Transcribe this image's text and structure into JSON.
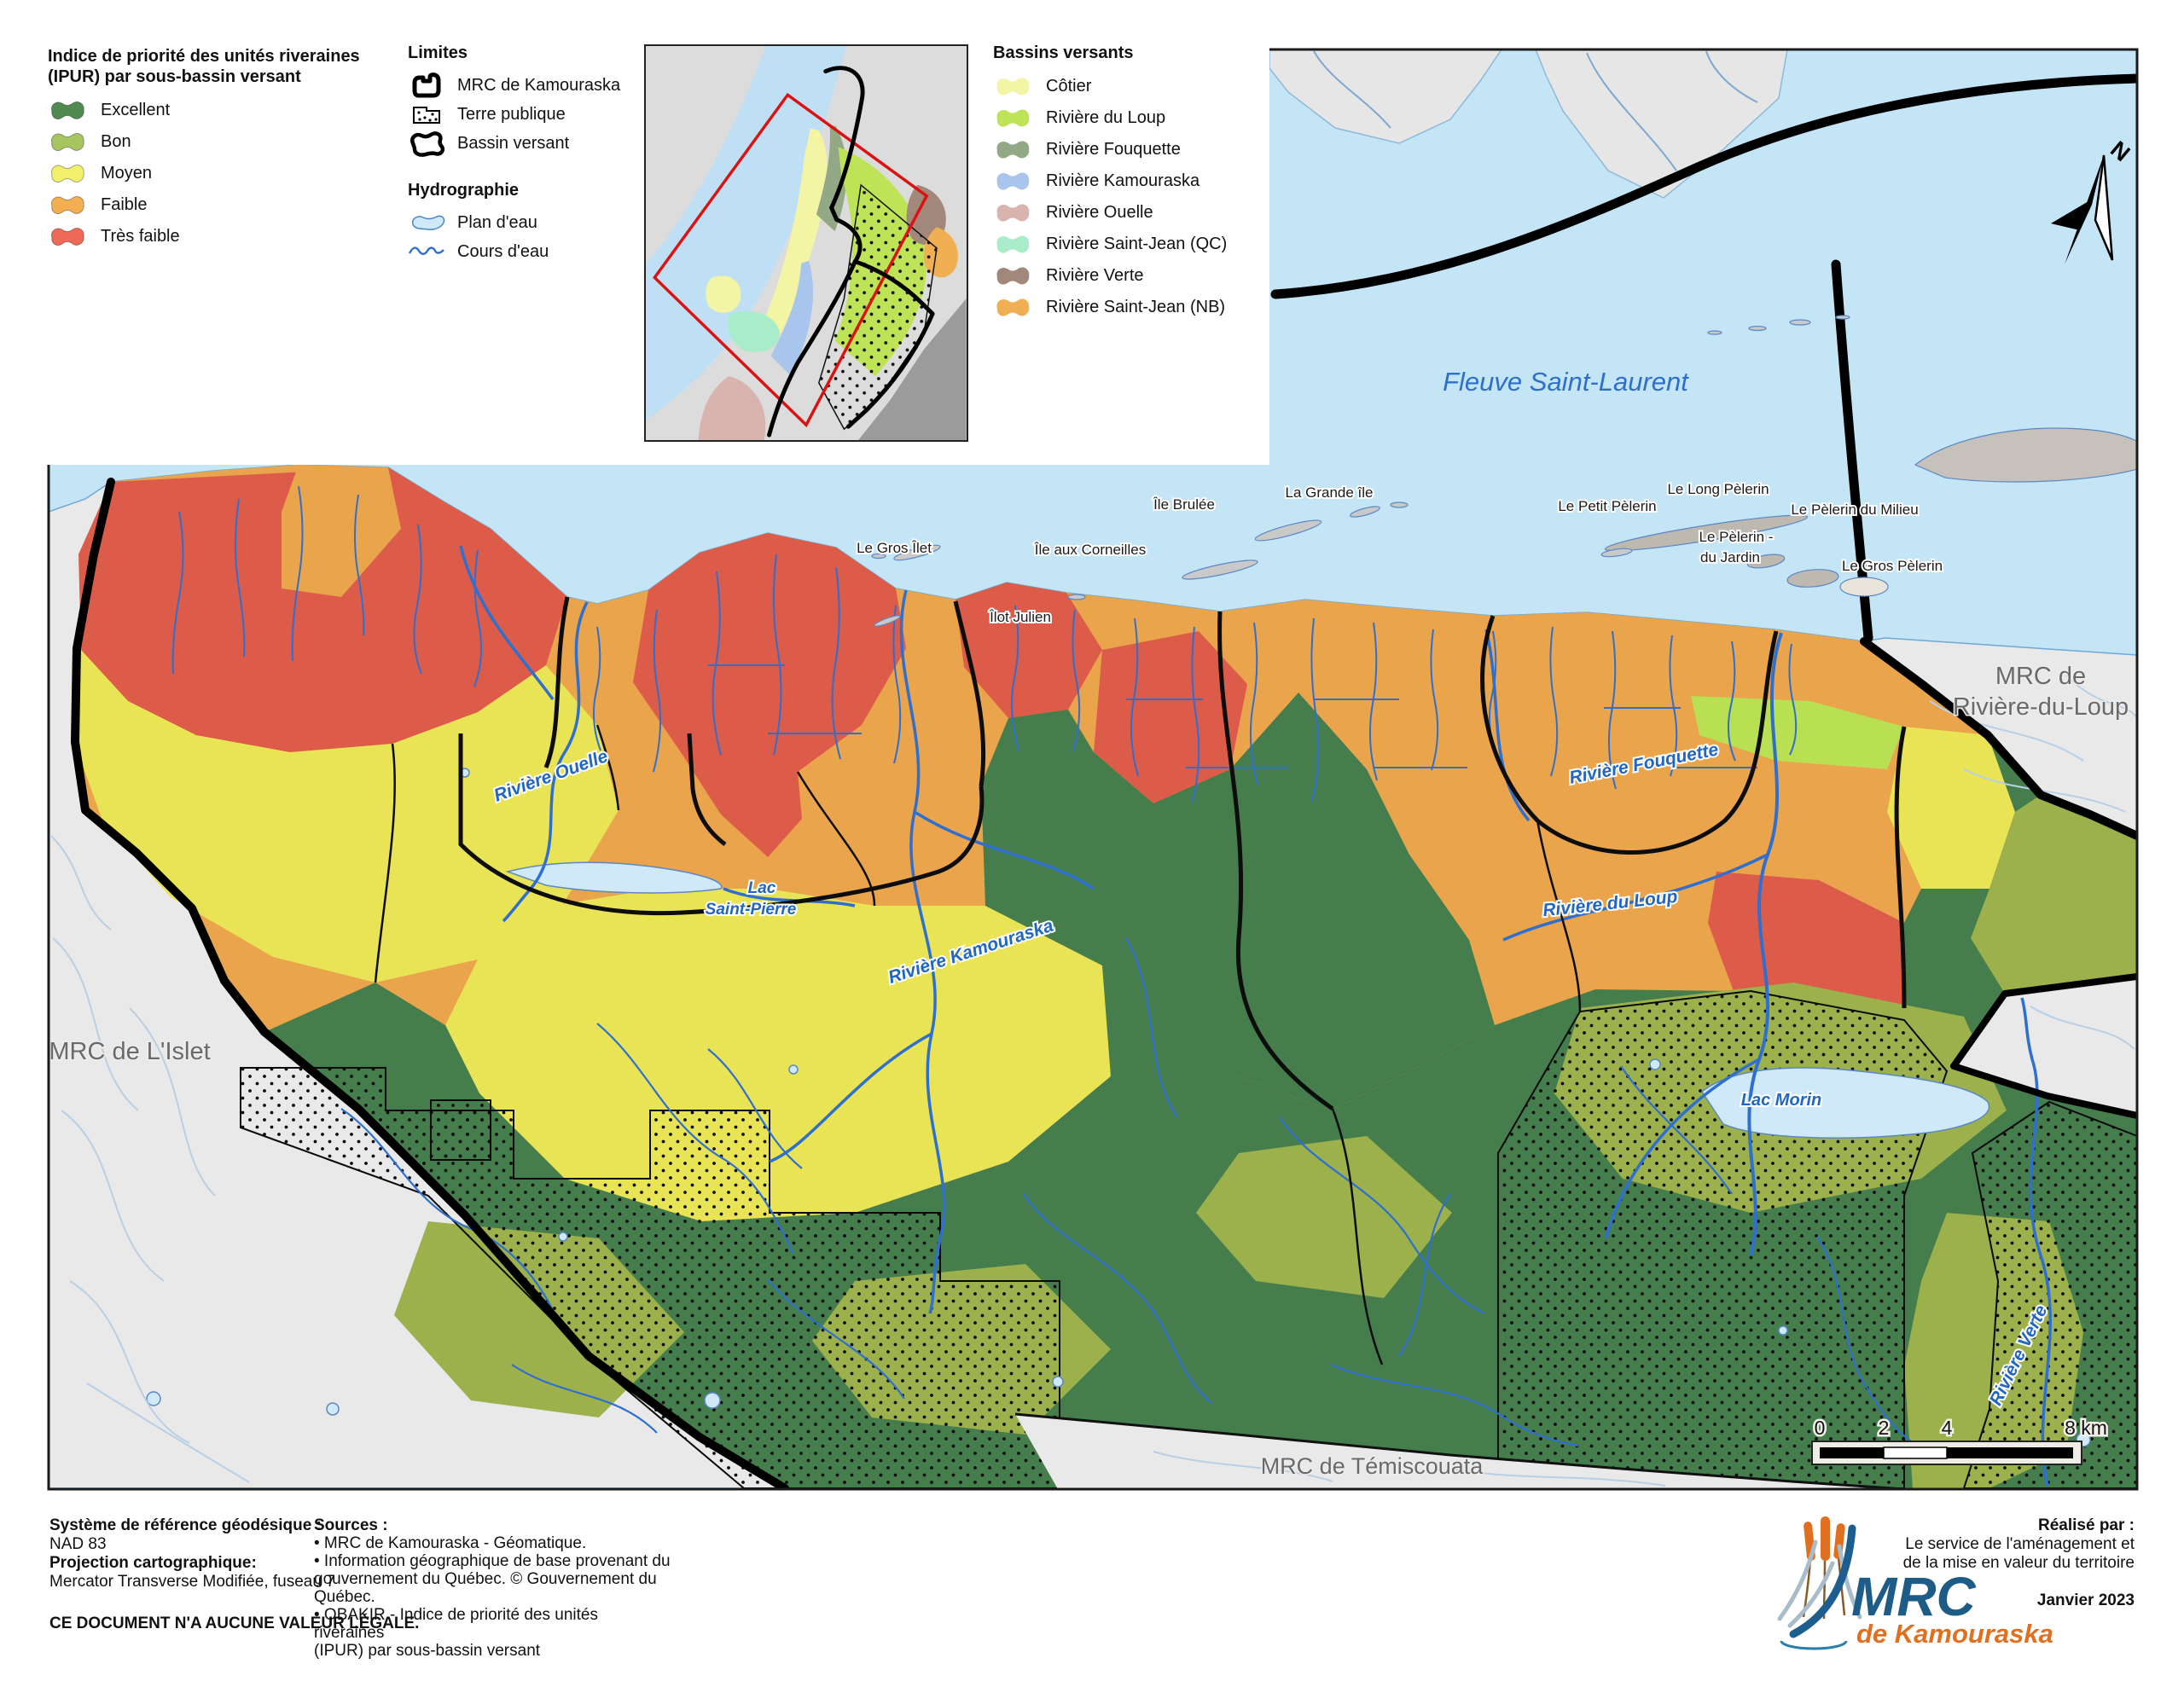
{
  "legend_ipur": {
    "title_line1": "Indice de priorité des unités riveraines",
    "title_line2": "(IPUR) par sous-bassin versant",
    "items": [
      {
        "label": "Excellent",
        "color": "#4f8b51"
      },
      {
        "label": "Bon",
        "color": "#a7c55e"
      },
      {
        "label": "Moyen",
        "color": "#f3ef6a"
      },
      {
        "label": "Faible",
        "color": "#f3ae51"
      },
      {
        "label": "Très faible",
        "color": "#ef6a56"
      }
    ]
  },
  "legend_limites": {
    "title": "Limites",
    "items": [
      {
        "label": "MRC de Kamouraska"
      },
      {
        "label": "Terre publique"
      },
      {
        "label": "Bassin versant"
      }
    ]
  },
  "legend_hydro": {
    "title": "Hydrographie",
    "items": [
      {
        "label": "Plan d'eau"
      },
      {
        "label": "Cours d'eau"
      }
    ]
  },
  "legend_bassins": {
    "title": "Bassins versants",
    "items": [
      {
        "label": "Côtier",
        "color": "#f4f4a5"
      },
      {
        "label": "Rivière du Loup",
        "color": "#bfe356"
      },
      {
        "label": "Rivière Fouquette",
        "color": "#93a884"
      },
      {
        "label": "Rivière Kamouraska",
        "color": "#a8c6ec"
      },
      {
        "label": "Rivière Ouelle",
        "color": "#d9b4ae"
      },
      {
        "label": "Rivière Saint-Jean (QC)",
        "color": "#a9ecca"
      },
      {
        "label": "Rivière Verte",
        "color": "#a1887a"
      },
      {
        "label": "Rivière Saint-Jean (NB)",
        "color": "#f0af52"
      }
    ]
  },
  "map": {
    "sea_label": "Fleuve Saint-Laurent",
    "islands": [
      "Le Gros Îlet",
      "Île Brulée",
      "La Grande île",
      "Île aux Corneilles",
      "Îlot Julien",
      "Le Petit Pèlerin",
      "Le Long Pèlerin",
      "Le Pèlerin du Milieu",
      "Le Pèlerin -",
      "du Jardin",
      "Le Gros Pèlerin"
    ],
    "neighbors": {
      "west": "MRC de L'Islet",
      "east_line1": "MRC de",
      "east_line2": "Rivière-du-Loup",
      "south": "MRC de Témiscouata"
    },
    "water_labels": {
      "riviere_ouelle": "Rivière Ouelle",
      "lac_line1": "Lac",
      "lac_line2": "Saint-Pierre",
      "riviere_kamouraska": "Rivière Kamouraska",
      "riviere_fouquette": "Rivière Fouquette",
      "riviere_du_loup": "Rivière du Loup",
      "lac_morin": "Lac Morin",
      "riviere_verte": "Rivière Verte"
    },
    "scalebar": {
      "t0": "0",
      "t2": "2",
      "t4": "4",
      "t8": "8 km"
    },
    "north_letter": "N"
  },
  "footer": {
    "ref_title": "Système de référence géodésique :",
    "ref_value": "NAD 83",
    "proj_title": "Projection cartographique:",
    "proj_value": "Mercator Transverse Modifiée, fuseau 7",
    "legal": "CE DOCUMENT N'A AUCUNE VALEUR LÉGALE.",
    "sources_title": "Sources :",
    "source1": "• MRC de Kamouraska - Géomatique.",
    "source2_line1": "• Information géographique de base provenant du",
    "source2_line2": "gouvernement du Québec. © Gouvernement du Québec.",
    "source3_line1": "• OBAKIR - Indice de priorité des unités riveraines",
    "source3_line2": "(IPUR) par sous-bassin versant",
    "credit_title": "Réalisé par :",
    "credit_line1": "Le service de l'aménagement et",
    "credit_line2": "de la mise en valeur du territoire",
    "date": "Janvier 2023"
  },
  "logo": {
    "mrc": "MRC",
    "sub": "de Kamouraska"
  }
}
